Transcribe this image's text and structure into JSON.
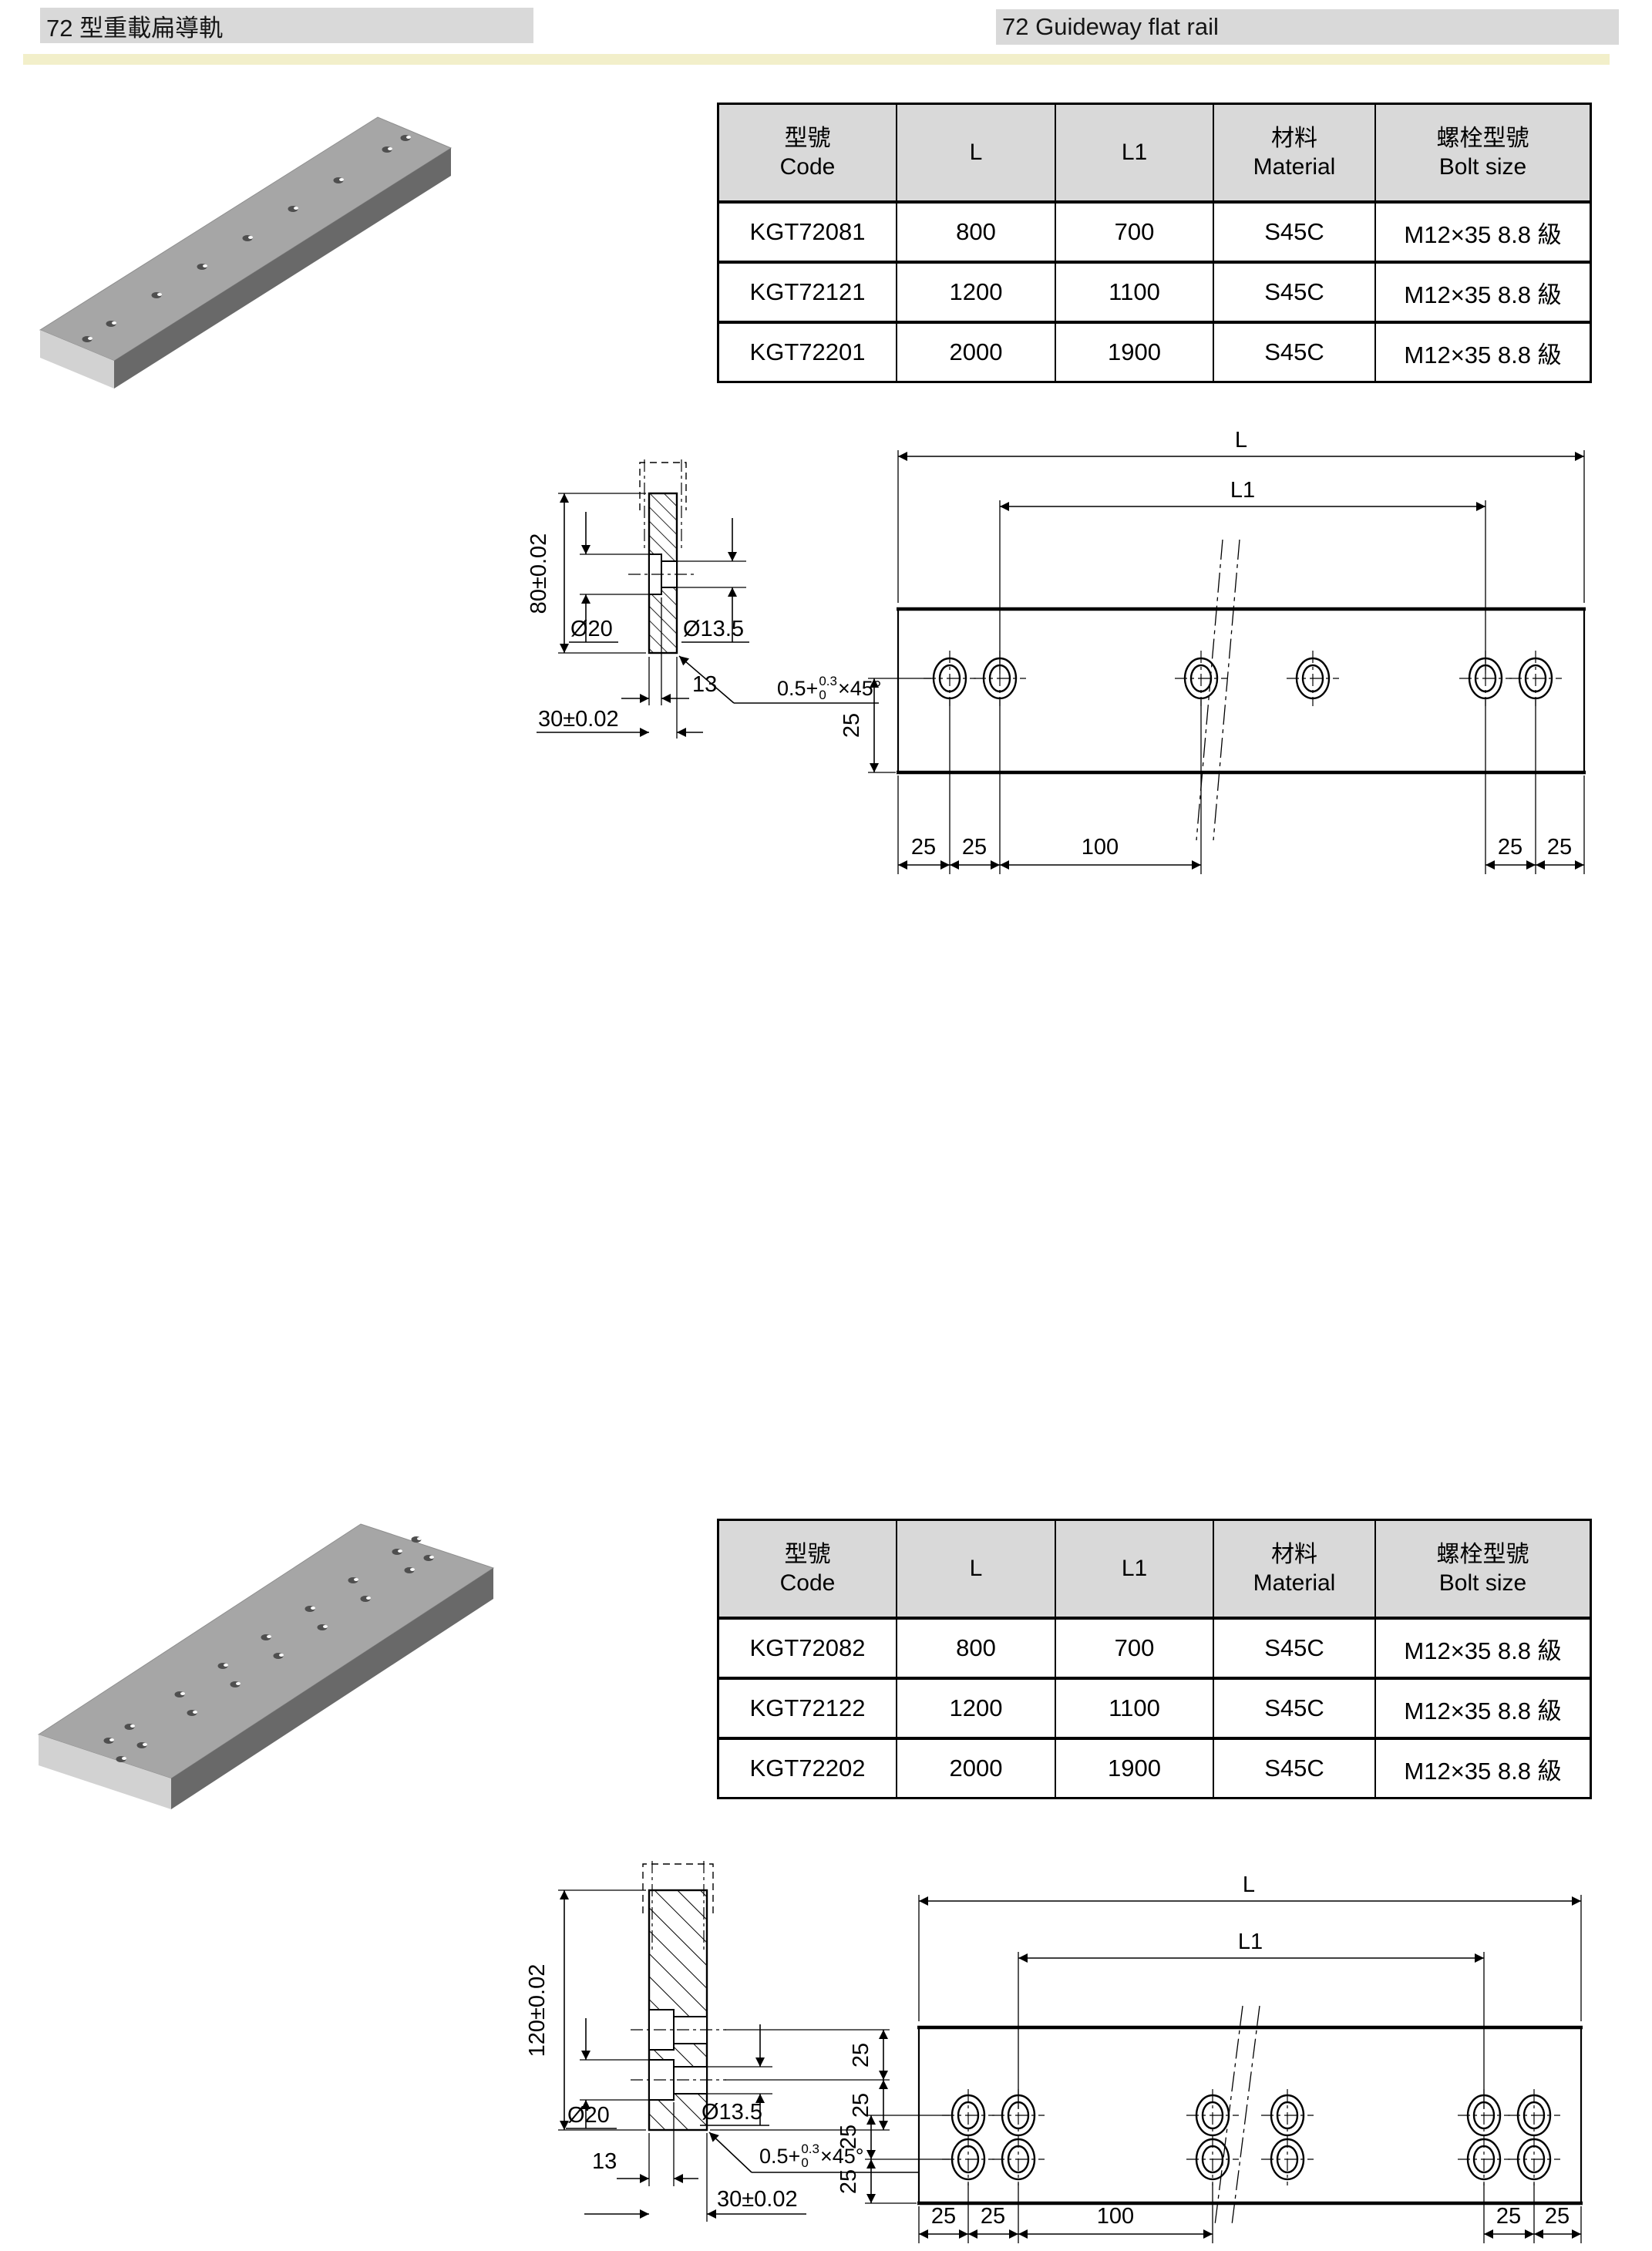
{
  "page": {
    "title_zh": "72 型重載扁導軌",
    "title_en": "72 Guideway flat rail"
  },
  "colors": {
    "header_bg": "#d9d9d9",
    "divider_band": "#f2efca",
    "table_header_bg": "#d9d9d9"
  },
  "table_headers": {
    "code_zh": "型號",
    "code_en": "Code",
    "l": "L",
    "l1": "L1",
    "material_zh": "材料",
    "material_en": "Material",
    "bolt_zh": "螺栓型號",
    "bolt_en": "Bolt size"
  },
  "tables": [
    {
      "rows": [
        {
          "code": "KGT72081",
          "l": "800",
          "l1": "700",
          "material": "S45C",
          "bolt": "M12×35 8.8 級"
        },
        {
          "code": "KGT72121",
          "l": "1200",
          "l1": "1100",
          "material": "S45C",
          "bolt": "M12×35 8.8 級"
        },
        {
          "code": "KGT72201",
          "l": "2000",
          "l1": "1900",
          "material": "S45C",
          "bolt": "M12×35 8.8 級"
        }
      ]
    },
    {
      "rows": [
        {
          "code": "KGT72082",
          "l": "800",
          "l1": "700",
          "material": "S45C",
          "bolt": "M12×35 8.8 級"
        },
        {
          "code": "KGT72122",
          "l": "1200",
          "l1": "1100",
          "material": "S45C",
          "bolt": "M12×35 8.8 級"
        },
        {
          "code": "KGT72202",
          "l": "2000",
          "l1": "1900",
          "material": "S45C",
          "bolt": "M12×35 8.8 級"
        }
      ]
    }
  ],
  "drawings": [
    {
      "section": {
        "height": "80±0.02",
        "cbore": "Ø20",
        "bore": "Ø13.5",
        "depth": "13",
        "width": "30±0.02"
      },
      "chamfer": {
        "base": "0.5+",
        "tol_up": "0.3",
        "tol_low": "0",
        "angle": "×45°"
      },
      "side": {
        "L": "L",
        "L1": "L1",
        "v25": "25",
        "b25a": "25",
        "b25b": "25",
        "b100": "100",
        "b25c": "25",
        "b25d": "25"
      }
    },
    {
      "section": {
        "height": "120±0.02",
        "cbore": "Ø20",
        "bore": "Ø13.5",
        "depth": "13",
        "width": "30±0.02",
        "r25a": "25",
        "r25b": "25"
      },
      "chamfer": {
        "base": "0.5+",
        "tol_up": "0.3",
        "tol_low": "0",
        "angle": "×45°"
      },
      "side": {
        "L": "L",
        "L1": "L1",
        "v25a": "25",
        "v25b": "25",
        "b25a": "25",
        "b25b": "25",
        "b100": "100",
        "b25c": "25",
        "b25d": "25"
      }
    }
  ]
}
